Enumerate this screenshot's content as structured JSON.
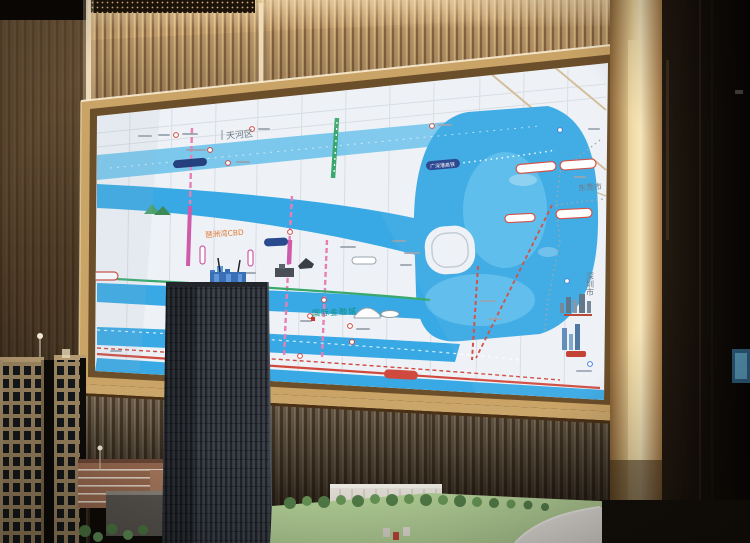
{
  "screen_map": {
    "district_label": "天河区",
    "city_labels": {
      "dongguan": "东莞市",
      "shenzhen": "深圳市"
    },
    "area_labels": {
      "financial_city": "国际金融城",
      "bay_cbd": "琶洲湾CBD"
    },
    "transit_labels": {
      "rail_pill": "广深港高铁"
    },
    "colors": {
      "water": "#38a9e4",
      "water_light": "#7cc8ec",
      "land": "#eef2f6",
      "metro_pink": "#e87fb4",
      "metro_magenta": "#cf5aaa",
      "metro_green": "#3aa86c",
      "expressway_red": "#d0493f",
      "rail_navy": "#22418c",
      "label_teal": "#12907e",
      "label_orange": "#e07a35",
      "label_gray": "#6a7480"
    }
  },
  "environment": {
    "colors": {
      "wood_slats": "#c09c6b",
      "gold_trim": "#d9b274",
      "frame_glint": "#f8ecd2",
      "rib_wall": "#74654f",
      "lawn": "#b7d49a",
      "model_table": "#ece9e4"
    }
  }
}
